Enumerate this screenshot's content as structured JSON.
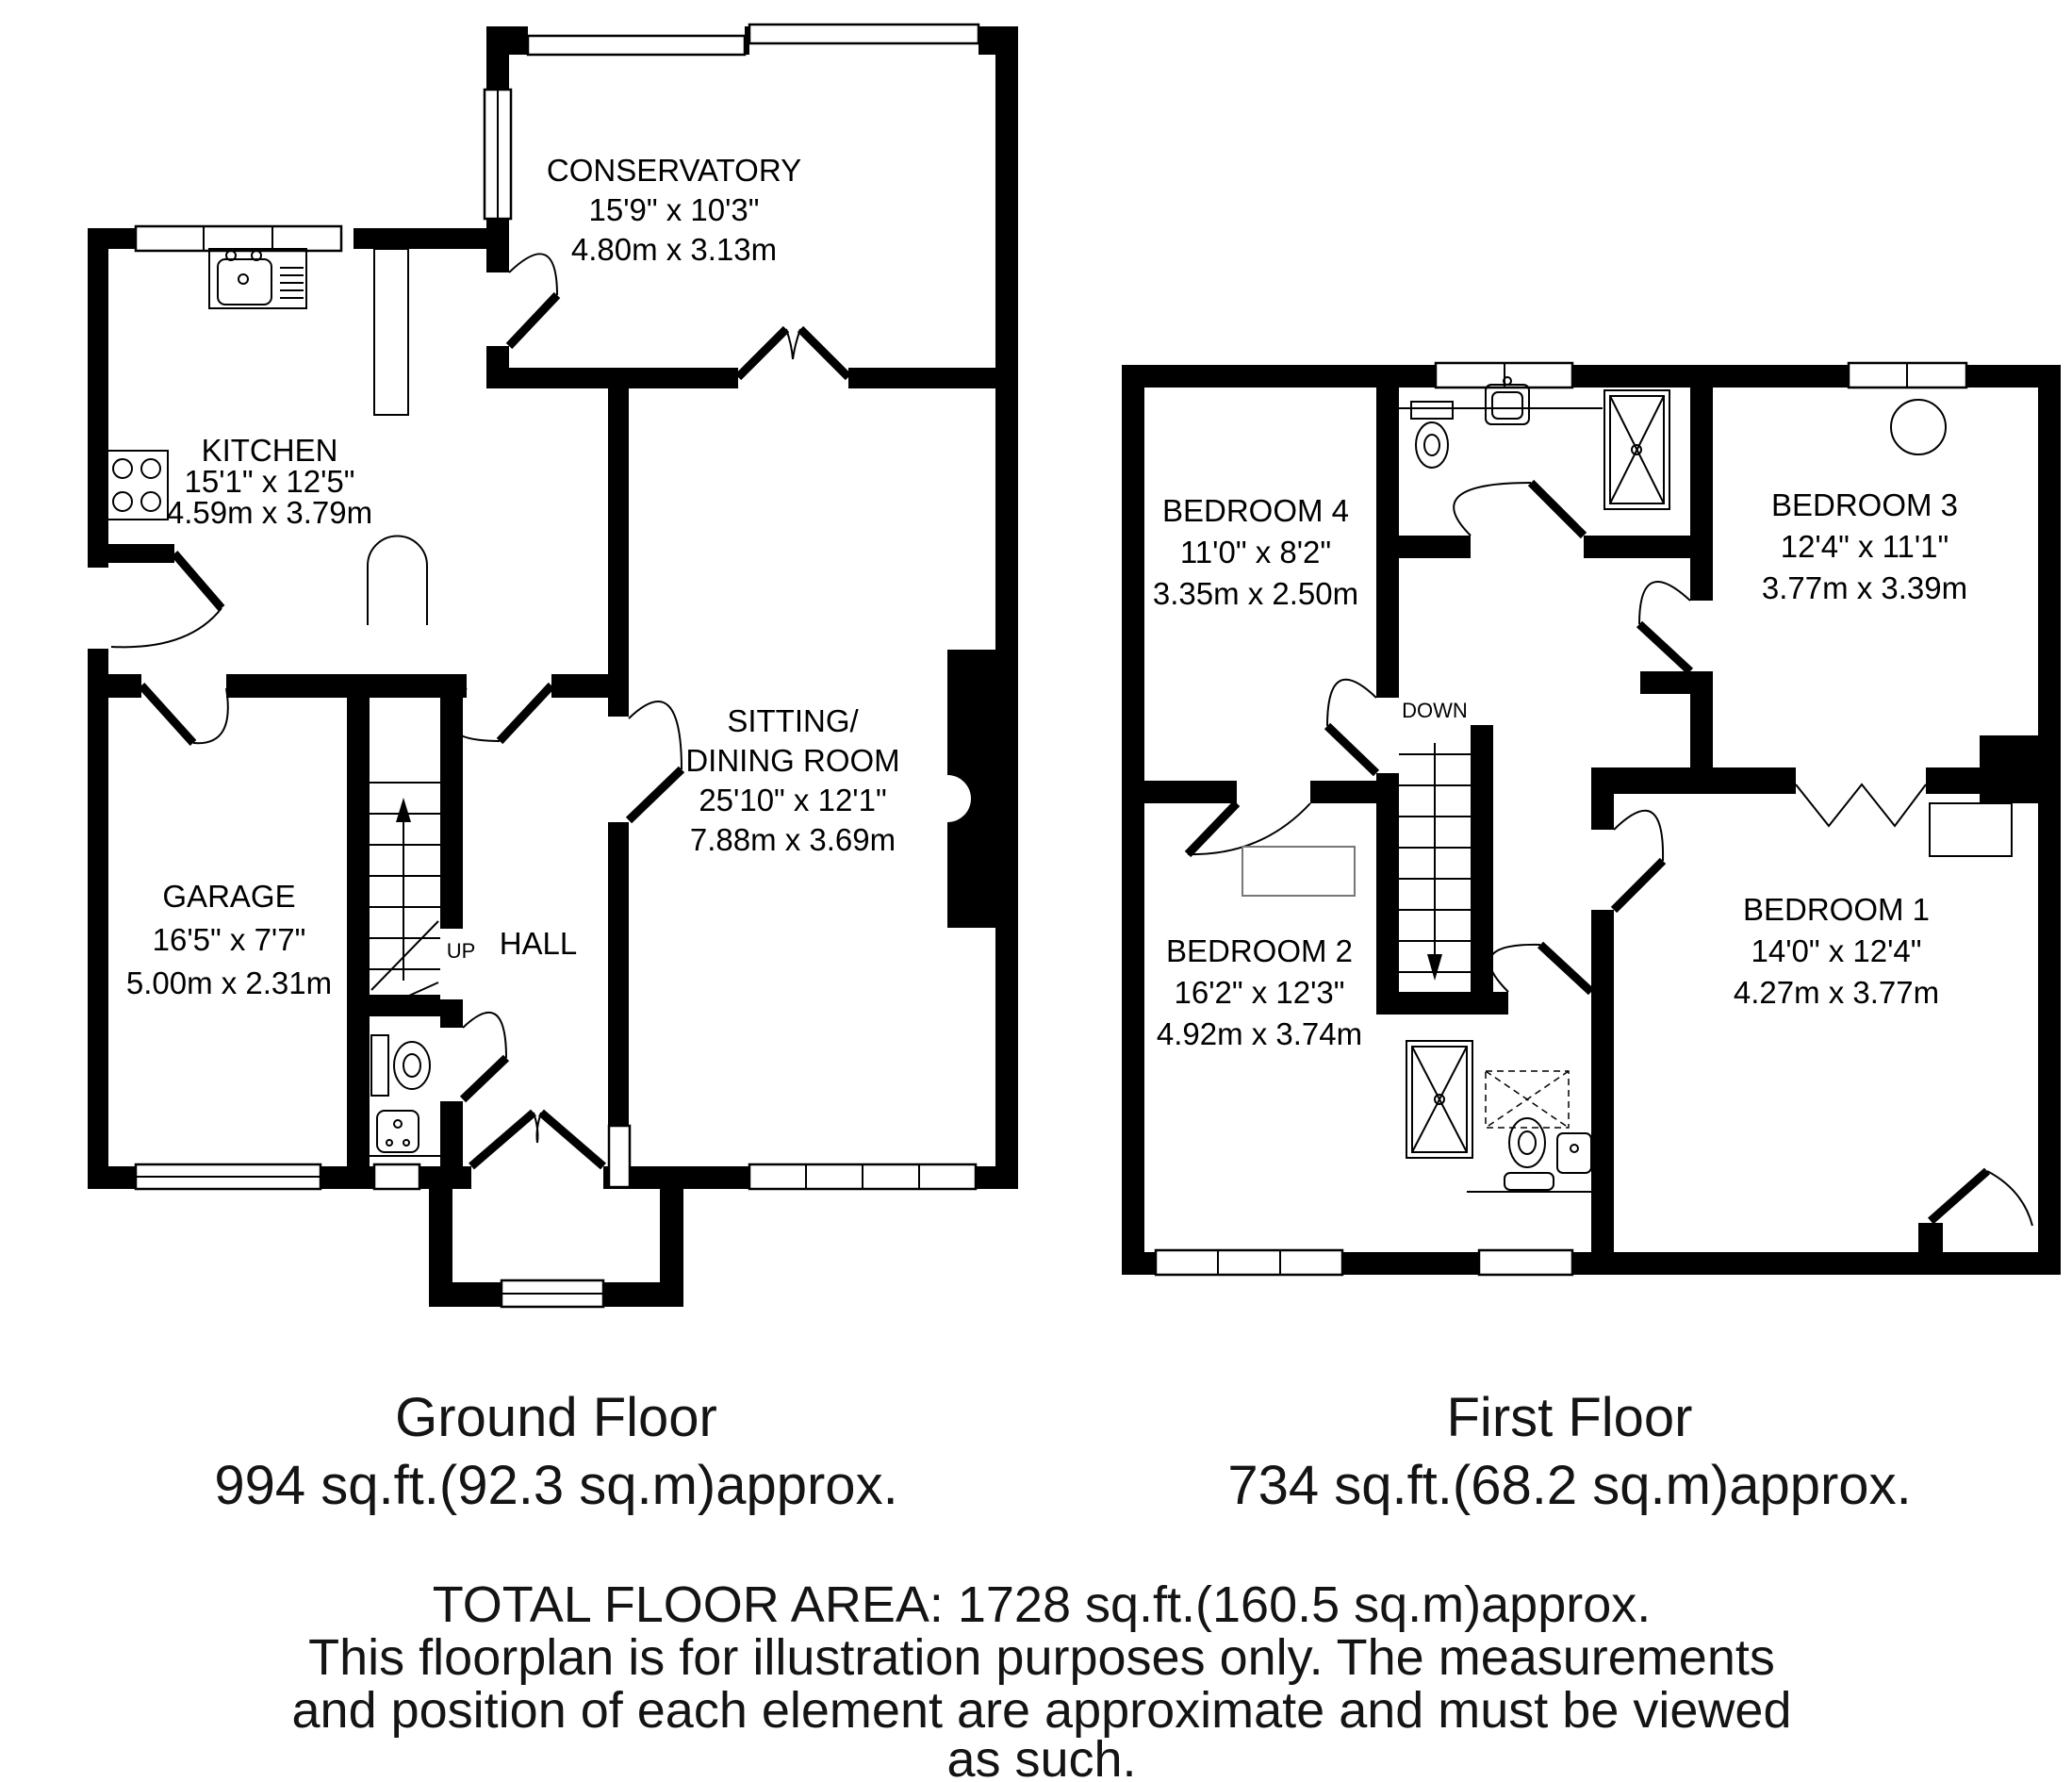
{
  "ground_floor": {
    "rooms": {
      "conservatory": {
        "lines": [
          "CONSERVATORY",
          "15'9\" x 10'3\"",
          "4.80m x 3.13m"
        ]
      },
      "kitchen": {
        "lines": [
          "KITCHEN",
          "15'1\" x 12'5\"",
          "4.59m x 3.79m"
        ]
      },
      "sitting": {
        "lines": [
          "SITTING/",
          "DINING ROOM",
          "25'10\" x 12'1\"",
          "7.88m x 3.69m"
        ]
      },
      "garage": {
        "lines": [
          "GARAGE",
          "16'5\" x 7'7\"",
          "5.00m x 2.31m"
        ]
      },
      "hall": {
        "lines": [
          "HALL"
        ]
      }
    },
    "stair_label": "UP",
    "caption": {
      "title": "Ground Floor",
      "area": "994 sq.ft.(92.3 sq.m)approx."
    }
  },
  "first_floor": {
    "rooms": {
      "bedroom4": {
        "lines": [
          "BEDROOM 4",
          "11'0\" x 8'2\"",
          "3.35m x 2.50m"
        ]
      },
      "bedroom3": {
        "lines": [
          "BEDROOM 3",
          "12'4\" x 11'1\"",
          "3.77m x 3.39m"
        ]
      },
      "bedroom2": {
        "lines": [
          "BEDROOM 2",
          "16'2\" x 12'3\"",
          "4.92m x 3.74m"
        ]
      },
      "bedroom1": {
        "lines": [
          "BEDROOM 1",
          "14'0\" x 12'4\"",
          "4.27m x 3.77m"
        ]
      }
    },
    "stair_label": "DOWN",
    "caption": {
      "title": "First Floor",
      "area": "734 sq.ft.(68.2 sq.m)approx."
    }
  },
  "footer": {
    "total": "TOTAL FLOOR AREA: 1728 sq.ft.(160.5 sq.m)approx.",
    "disclaimer1": "This floorplan is for illustration purposes only. The measurements",
    "disclaimer2": "and position of each element are approximate and must be viewed",
    "disclaimer3": "as such."
  },
  "colors": {
    "walls": "#000000",
    "background": "#ffffff",
    "text": "#141414"
  }
}
